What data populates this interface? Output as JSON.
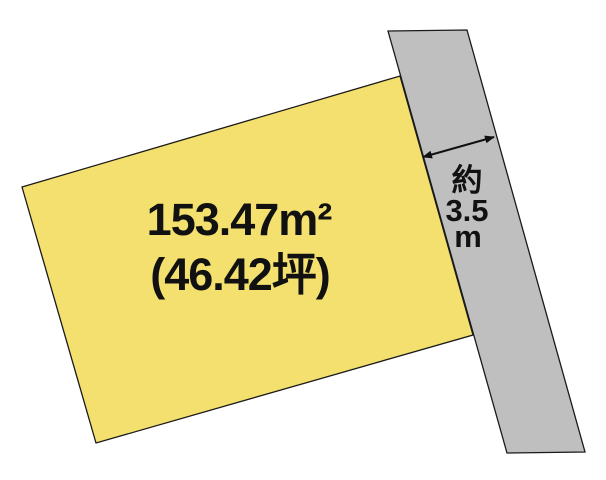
{
  "diagram": {
    "background_color": "#ffffff",
    "parcel": {
      "labels": [
        "153.47m²",
        "(46.42坪)"
      ],
      "fill_color": "#f4e06e",
      "outline_color": "#1a1a1a",
      "points": "22,187 400,76 473,335 96,443"
    },
    "road": {
      "fill_color": "#bfbfbf",
      "outline_color": "#1a1a1a",
      "points": "388,31 467,30 585,452 507,453"
    },
    "road_width_annotation": {
      "lines": [
        "約",
        "3.5",
        "m"
      ],
      "arrow_color": "#111111",
      "arrow_points": "423,157 494,137"
    }
  }
}
